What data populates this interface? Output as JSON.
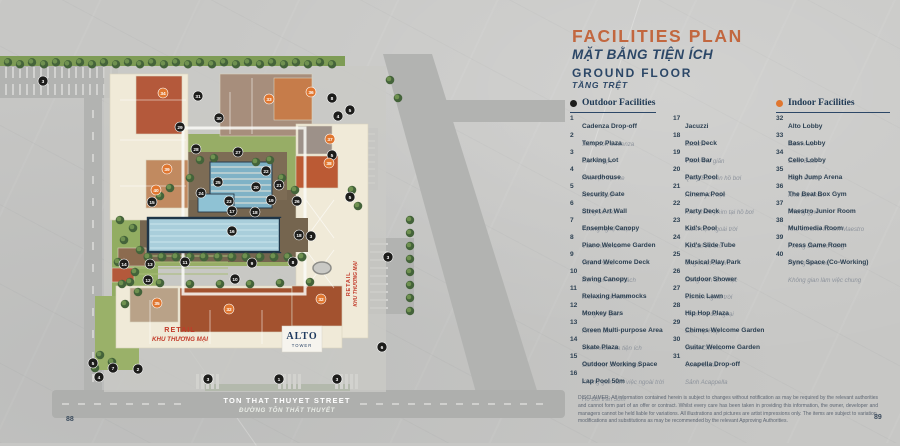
{
  "page": {
    "left_number": "88",
    "right_number": "89"
  },
  "header": {
    "title": "FACILITIES PLAN",
    "title_vi": "MẶT BẰNG TIỆN ÍCH",
    "floor": "GROUND FLOOR",
    "floor_vi": "TẦNG TRỆT"
  },
  "legend": {
    "outdoor": {
      "label": "Outdoor Facilities",
      "dot_color": "#1d1d1b",
      "items": [
        {
          "num": 1,
          "name": "Cadenza Drop-off",
          "name_vi": "Sảnh đón Cadenza"
        },
        {
          "num": 2,
          "name": "Tempo Plaza",
          "name_vi": "Sân Tempo"
        },
        {
          "num": 3,
          "name": "Parking Lot",
          "name_vi": "Khu vực đậu xe"
        },
        {
          "num": 4,
          "name": "Guardhouse",
          "name_vi": "Nhà bảo vệ"
        },
        {
          "num": 5,
          "name": "Security Gate",
          "name_vi": "Cổng an ninh"
        },
        {
          "num": 6,
          "name": "Street Art Wall",
          "name_vi": "Tường nghệ thuật"
        },
        {
          "num": 7,
          "name": "Ensemble Canopy",
          "name_vi": "Vòm thanh âm"
        },
        {
          "num": 8,
          "name": "Piano Welcome Garden",
          "name_vi": "Vườn Piano"
        },
        {
          "num": 9,
          "name": "Grand Welcome Deck",
          "name_vi": "Đại sảnh đón khách"
        },
        {
          "num": 10,
          "name": "Swing Canopy",
          "name_vi": "Xích đu sân vườn"
        },
        {
          "num": 11,
          "name": "Relaxing Hammocks",
          "name_vi": "Võng thư giãn"
        },
        {
          "num": 12,
          "name": "Monkey Bars",
          "name_vi": "Khu xà đơn"
        },
        {
          "num": 13,
          "name": "Green Multi-purpose Area",
          "name_vi": "Vườn xanh đa tiện ích"
        },
        {
          "num": 14,
          "name": "Skate Plaza",
          "name_vi": "Sân trượt Skateboard"
        },
        {
          "num": 15,
          "name": "Outdoor Working Space",
          "name_vi": "Không gian làm việc ngoài trời"
        },
        {
          "num": 16,
          "name": "Lap Pool 50m",
          "name_vi": "Hồ bơi tràn 50m"
        },
        {
          "num": 17,
          "name": "Jacuzzi",
          "name_vi": "Jacuzzi"
        },
        {
          "num": 18,
          "name": "Pool Deck",
          "name_vi": "Thềm thư giãn"
        },
        {
          "num": 19,
          "name": "Pool Bar",
          "name_vi": "Quầy Bar bên hồ bơi"
        },
        {
          "num": 20,
          "name": "Party Pool",
          "name_vi": "Hồ bơi yến tiệc"
        },
        {
          "num": 21,
          "name": "Cinema Pool",
          "name_vi": "Khu chiếu phim tại hồ bơi"
        },
        {
          "num": 22,
          "name": "Party Deck",
          "name_vi": "Sảnh tiệc ngoài trời"
        },
        {
          "num": 23,
          "name": "Kid's Pool",
          "name_vi": "Hồ bơi trẻ em"
        },
        {
          "num": 24,
          "name": "Kid's Slide Tube",
          "name_vi": "Ống trượt trẻ em"
        },
        {
          "num": 25,
          "name": "Musical Play Park",
          "name_vi": "Công viên âm nhạc"
        },
        {
          "num": 26,
          "name": "Outdoor Shower",
          "name_vi": "Vòi sen ngoài trời"
        },
        {
          "num": 27,
          "name": "Picnic Lawn",
          "name_vi": "Thảm cỏ dã ngoại"
        },
        {
          "num": 28,
          "name": "Hip Hop Plaza",
          "name_vi": "Sân Hip Hop"
        },
        {
          "num": 29,
          "name": "Chimes Welcome Garden",
          "name_vi": "Vườn Chimes"
        },
        {
          "num": 30,
          "name": "Guitar Welcome Garden",
          "name_vi": "Vườn Guitar"
        },
        {
          "num": 31,
          "name": "Acapella Drop-off",
          "name_vi": "Sảnh Acappella"
        }
      ]
    },
    "indoor": {
      "label": "Indoor Facilities",
      "dot_color": "#e0762f",
      "items": [
        {
          "num": 32,
          "name": "Alto Lobby",
          "name_vi": "Sảnh Alto"
        },
        {
          "num": 33,
          "name": "Bass Lobby",
          "name_vi": "Sảnh Bass"
        },
        {
          "num": 34,
          "name": "Cello Lobby",
          "name_vi": "Sảnh Cello"
        },
        {
          "num": 35,
          "name": "High Jump Arena",
          "name_vi": "Nhà bật nhún"
        },
        {
          "num": 36,
          "name": "The Beat Box Gym",
          "name_vi": "Phòng gym"
        },
        {
          "num": 37,
          "name": "Maestro Junior Room",
          "name_vi": "Khu vui chơi trẻ em Maestro"
        },
        {
          "num": 38,
          "name": "Multimedia Room",
          "name_vi": "Phòng đa chức năng"
        },
        {
          "num": 39,
          "name": "Press Game Room",
          "name_vi": "Phòng trò chơi"
        },
        {
          "num": 40,
          "name": "Sync Space (Co-Working)",
          "name_vi": "Không gian làm việc chung"
        }
      ]
    }
  },
  "map": {
    "street": {
      "name": "TON THAT THUYET STREET",
      "name_vi": "ĐƯỜNG TÔN THẤT THUYẾT"
    },
    "retail_bottom": {
      "line1": "RETAIL",
      "line2": "KHU THƯƠNG MẠI"
    },
    "retail_right": {
      "line1": "RETAIL",
      "line2": "KHU THƯƠNG MẠI"
    },
    "tower": {
      "name": "ALTO",
      "sub": "TOWER"
    },
    "markers": {
      "outdoor": [
        {
          "n": "3",
          "x": 43,
          "y": 81
        },
        {
          "n": "31",
          "x": 198,
          "y": 96
        },
        {
          "n": "8",
          "x": 332,
          "y": 98
        },
        {
          "n": "4",
          "x": 338,
          "y": 116
        },
        {
          "n": "5",
          "x": 350,
          "y": 110
        },
        {
          "n": "30",
          "x": 219,
          "y": 118
        },
        {
          "n": "29",
          "x": 180,
          "y": 127
        },
        {
          "n": "28",
          "x": 196,
          "y": 149
        },
        {
          "n": "27",
          "x": 238,
          "y": 152
        },
        {
          "n": "5",
          "x": 332,
          "y": 155
        },
        {
          "n": "22",
          "x": 266,
          "y": 171
        },
        {
          "n": "25",
          "x": 218,
          "y": 182
        },
        {
          "n": "20",
          "x": 256,
          "y": 187
        },
        {
          "n": "21",
          "x": 279,
          "y": 185
        },
        {
          "n": "24",
          "x": 201,
          "y": 193
        },
        {
          "n": "5",
          "x": 350,
          "y": 197
        },
        {
          "n": "15",
          "x": 152,
          "y": 202
        },
        {
          "n": "23",
          "x": 229,
          "y": 201
        },
        {
          "n": "19",
          "x": 271,
          "y": 200
        },
        {
          "n": "26",
          "x": 297,
          "y": 201
        },
        {
          "n": "17",
          "x": 232,
          "y": 211
        },
        {
          "n": "18",
          "x": 255,
          "y": 212
        },
        {
          "n": "16",
          "x": 232,
          "y": 231
        },
        {
          "n": "18",
          "x": 299,
          "y": 235
        },
        {
          "n": "3",
          "x": 311,
          "y": 236
        },
        {
          "n": "3",
          "x": 388,
          "y": 257
        },
        {
          "n": "14",
          "x": 124,
          "y": 264
        },
        {
          "n": "13",
          "x": 150,
          "y": 264
        },
        {
          "n": "11",
          "x": 185,
          "y": 262
        },
        {
          "n": "9",
          "x": 252,
          "y": 263
        },
        {
          "n": "8",
          "x": 293,
          "y": 262
        },
        {
          "n": "12",
          "x": 148,
          "y": 280
        },
        {
          "n": "10",
          "x": 235,
          "y": 279
        },
        {
          "n": "6",
          "x": 382,
          "y": 347
        },
        {
          "n": "5",
          "x": 93,
          "y": 363
        },
        {
          "n": "7",
          "x": 113,
          "y": 368
        },
        {
          "n": "2",
          "x": 138,
          "y": 369
        },
        {
          "n": "4",
          "x": 99,
          "y": 377
        },
        {
          "n": "3",
          "x": 208,
          "y": 379
        },
        {
          "n": "1",
          "x": 279,
          "y": 379
        },
        {
          "n": "3",
          "x": 337,
          "y": 379
        }
      ],
      "indoor": [
        {
          "n": "34",
          "x": 163,
          "y": 93
        },
        {
          "n": "33",
          "x": 269,
          "y": 99
        },
        {
          "n": "36",
          "x": 311,
          "y": 92
        },
        {
          "n": "37",
          "x": 330,
          "y": 139
        },
        {
          "n": "38",
          "x": 329,
          "y": 163
        },
        {
          "n": "39",
          "x": 167,
          "y": 169
        },
        {
          "n": "40",
          "x": 156,
          "y": 190
        },
        {
          "n": "35",
          "x": 157,
          "y": 303
        },
        {
          "n": "32",
          "x": 229,
          "y": 309
        },
        {
          "n": "32",
          "x": 321,
          "y": 299
        }
      ]
    }
  },
  "disclaimer": "DISCLAIMER: All information contained herein is subject to changes without notification as may be required by the relevant authorities and cannot form part of an offer or contract. Whilst every care has been taken in providing this information, the owner, developer and managers cannot be held liable for variations. All illustrations and pictures are artist impressions only. The items are subject to variation, modifications and substitutions as may be recommended by the relevant Approving Authorities.",
  "colors": {
    "accent": "#c2673f",
    "navy": "#2c4767",
    "marker_outdoor": "#1d1d1b",
    "marker_indoor": "#e0762f",
    "pool": "#a9cedb",
    "roof_orange": "#b4593b",
    "lawn": "#92ad62"
  }
}
